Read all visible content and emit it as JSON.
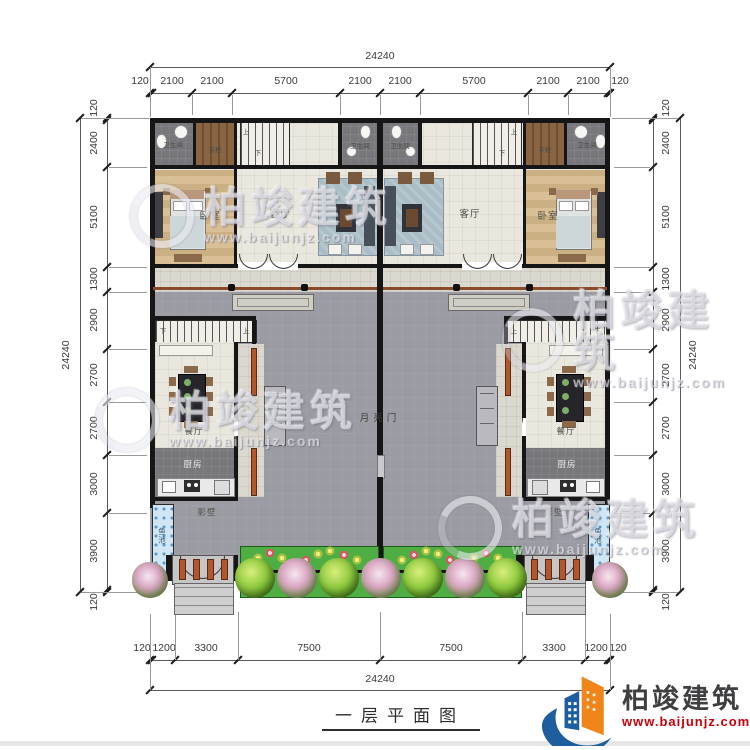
{
  "title": "一层平面图",
  "logo": {
    "name": "柏竣建筑",
    "url": "www.baijunjz.com"
  },
  "watermark": {
    "brand": "柏竣建筑",
    "url": "www.baijunjz.com"
  },
  "colors": {
    "brand_blue": "#1d5f9e",
    "brand_orange": "#f08519",
    "brand_red": "#c7000b",
    "garden_green": "#4fae43",
    "pond_blue": "#cfe7f5",
    "courtyard_gray": "#9b9ba3"
  },
  "labels": {
    "bathroom": "卫生间",
    "wardrobe": "衣柜",
    "bedroom": "卧室",
    "living": "客厅",
    "dining": "餐厅",
    "kitchen": "厨房",
    "moon_gate": "月亮门",
    "screen_wall": "影壁",
    "fish_pond": "鱼池",
    "up": "上",
    "down": "下"
  },
  "dimensions": {
    "overall": "24240",
    "top_segments": [
      "120",
      "2100",
      "2100",
      "5700",
      "2100",
      "2100",
      "5700",
      "2100",
      "2100",
      "120"
    ],
    "side_segments": [
      "120",
      "2400",
      "5100",
      "1300",
      "2900",
      "2700",
      "2700",
      "3000",
      "3900",
      "120"
    ],
    "bottom_segments": [
      "120",
      "1200",
      "3300",
      "7500",
      "7500",
      "3300",
      "1200",
      "120"
    ]
  }
}
